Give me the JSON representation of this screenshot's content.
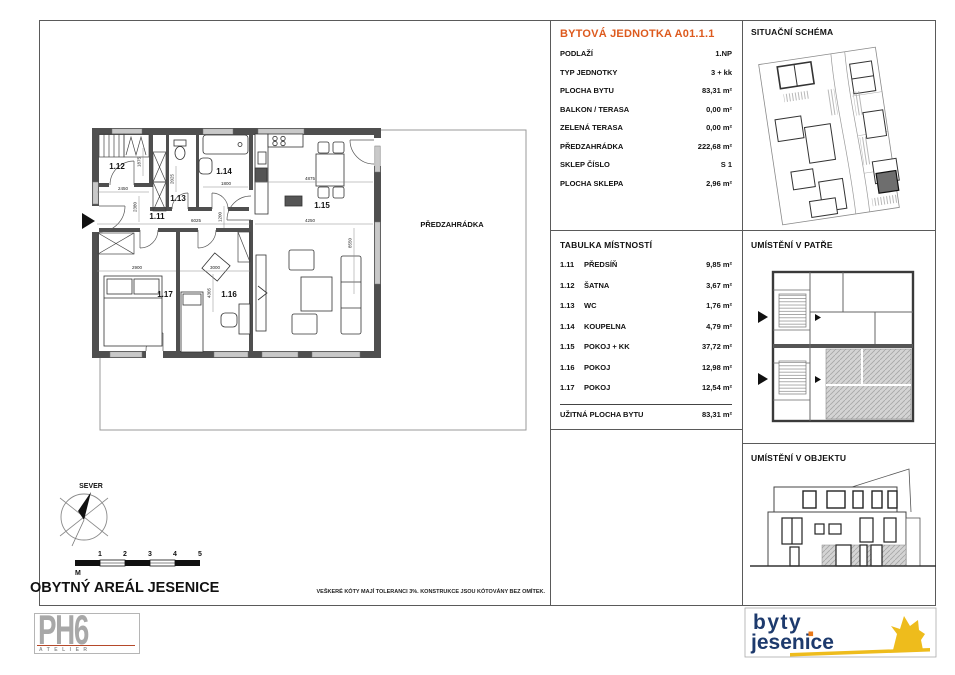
{
  "colors": {
    "accent_orange": "#dd5a1e",
    "wall_gray": "#4f4f4f",
    "window_gray": "#c9c9c9",
    "logo_navy": "#1d3a6d",
    "logo_gold": "#eebc1c",
    "logo_dot_orange": "#e87818",
    "ph6_gray": "#a8a8a8",
    "ph6_line_red": "#b5492a"
  },
  "unit_info": {
    "title": "BYTOVÁ JEDNOTKA A01.1.1",
    "rows": [
      {
        "label": "PODLAŽÍ",
        "value": "1.NP"
      },
      {
        "label": "TYP JEDNOTKY",
        "value": "3 + kk"
      },
      {
        "label": "PLOCHA BYTU",
        "value": "83,31 m²"
      },
      {
        "label": "BALKON / TERASA",
        "value": "0,00 m²"
      },
      {
        "label": "ZELENÁ TERASA",
        "value": "0,00 m²"
      },
      {
        "label": "PŘEDZAHRÁDKA",
        "value": "222,68 m²"
      },
      {
        "label": "SKLEP ČÍSLO",
        "value": "S 1"
      },
      {
        "label": "PLOCHA SKLEPA",
        "value": "2,96 m²"
      }
    ]
  },
  "room_table": {
    "title": "TABULKA MÍSTNOSTÍ",
    "rows": [
      {
        "num": "1.11",
        "name": "PŘEDSÍŇ",
        "area": "9,85 m²"
      },
      {
        "num": "1.12",
        "name": "ŠATNA",
        "area": "3,67 m²"
      },
      {
        "num": "1.13",
        "name": "WC",
        "area": "1,76 m²"
      },
      {
        "num": "1.14",
        "name": "KOUPELNA",
        "area": "4,79 m²"
      },
      {
        "num": "1.15",
        "name": "POKOJ + KK",
        "area": "37,72 m²"
      },
      {
        "num": "1.16",
        "name": "POKOJ",
        "area": "12,98 m²"
      },
      {
        "num": "1.17",
        "name": "POKOJ",
        "area": "12,54 m²"
      }
    ],
    "total_label": "UŽITNÁ PLOCHA BYTU",
    "total_value": "83,31 m²"
  },
  "panels": {
    "situation_title": "SITUAČNÍ SCHÉMA",
    "floor_title": "UMÍSTĚNÍ V PATŘE",
    "building_title": "UMÍSTĚNÍ V OBJEKTU"
  },
  "floorplan": {
    "garden_label": "PŘEDZAHRÁDKA",
    "rooms": {
      "r11": "1.11",
      "r12": "1.12",
      "r13": "1.13",
      "r14": "1.14",
      "r15": "1.15",
      "r16": "1.16",
      "r17": "1.17"
    },
    "dims": {
      "d2450": "2450",
      "d2380": "2380",
      "d1875": "1875",
      "d2025": "2025",
      "d1800": "1800",
      "d6025": "6025",
      "d1200": "1200",
      "d4875": "4875",
      "d4250": "4250",
      "d8550": "8550",
      "d2900": "2900",
      "d3000": "3000",
      "d4305": "4305"
    }
  },
  "footer": {
    "compass_label": "SEVER",
    "scale_marks": [
      "1",
      "2",
      "3",
      "4",
      "5"
    ],
    "scale_unit": "M",
    "project_title": "OBYTNÝ AREÁL JESENICE",
    "disclaimer": "VEŠKERÉ KÓTY MAJÍ TOLERANCI 3%. KONSTRUKCE JSOU KÓTOVÁNY BEZ OMÍTEK."
  },
  "logos": {
    "architect_name": "PH6",
    "architect_sub": "ATELIER",
    "developer_line1": "byty",
    "developer_line2": "jesenice"
  }
}
